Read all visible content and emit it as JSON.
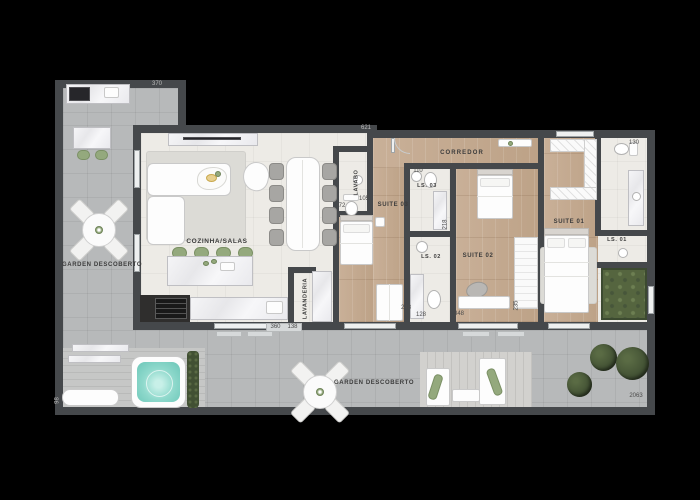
{
  "meta": {
    "title": "Apartment floor plan with terrace",
    "plan_type": "floor-plan"
  },
  "colors": {
    "wall": "#45484b",
    "tile": "#b7b9ba",
    "interior": "#edebe6",
    "stool_green": "#94a97d",
    "water_teal": "#8fd9cc",
    "foliage": "#415033",
    "planter": "#55653f"
  },
  "rooms": {
    "garden_left": "GARDEN DESCOBERTO",
    "garden_bottom": "GARDEN DESCOBERTO",
    "kitchen_living": "COZINHA/SALAS",
    "corridor": "CORREDOR",
    "powder_room": "LAVABO",
    "laundry": "LAVANDERIA",
    "suite_01": "SUITE 01",
    "suite_02": "SUITE 02",
    "suite_03": "SUITE 03",
    "bath_01": "LS. 01",
    "bath_02": "LS. 02",
    "bath_03": "LS. 03"
  },
  "dimensions": {
    "bbq_wall": "370",
    "corridor_top": "621",
    "bath01_top": "130",
    "bath03_top": "110",
    "powder_door": "72",
    "suite03_label_side": "105",
    "bath03_side": "218",
    "bath02_bottom_a": "248",
    "bath02_bottom_b": "128",
    "suite02_bottom": "348",
    "suite02_side": "235",
    "kitchen_bottom_a": "360",
    "kitchen_bottom_b": "138",
    "terrace_left": "98",
    "terrace_bottom_right": "2063"
  }
}
